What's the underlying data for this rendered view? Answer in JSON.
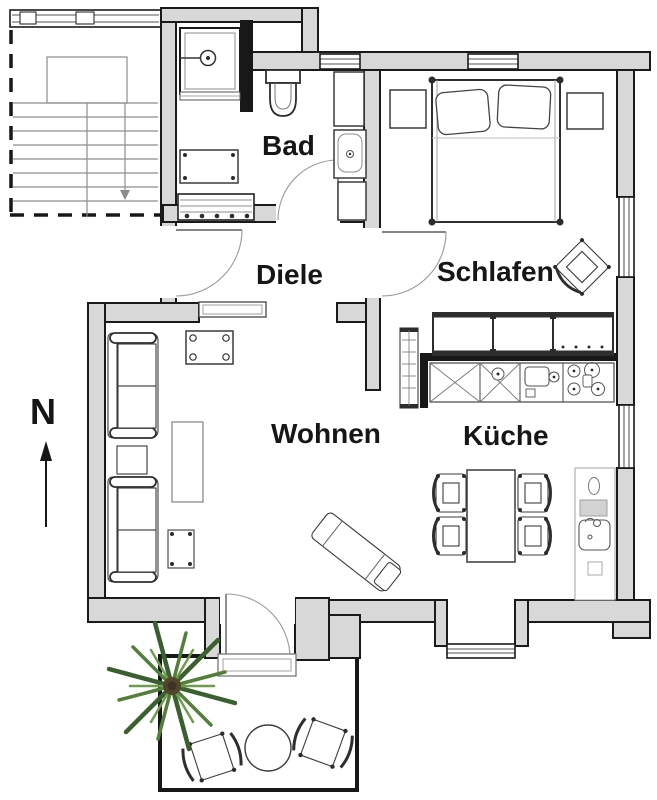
{
  "plan": {
    "type": "apartment-floor-plan",
    "units_shown": false
  },
  "rooms": [
    {
      "id": "bad",
      "label": "Bad"
    },
    {
      "id": "diele",
      "label": "Diele"
    },
    {
      "id": "schlafen",
      "label": "Schlafen"
    },
    {
      "id": "wohnen",
      "label": "Wohnen"
    },
    {
      "id": "kueche",
      "label": "Küche"
    }
  ],
  "compass": {
    "north_label": "N"
  },
  "colors": {
    "background": "#ffffff",
    "wall_fill": "#d8d8d8",
    "outline": "#1a1a1a",
    "furniture_line": "#3c3c3c",
    "light_line": "#8c8c8c",
    "plant_dark": "#39602e",
    "plant_mid": "#527f3a",
    "plant_light": "#6f9c4e",
    "plant_trunk": "#53452c"
  },
  "icons": [
    "staircase-icon",
    "shower-icon",
    "toilet-icon",
    "washbasin-icon",
    "bath-cabinet-icon",
    "washing-machine-icon",
    "hall-wardrobe-icon",
    "doormat-icon",
    "double-bed-icon",
    "pillow-icon",
    "nightstand-icon",
    "bedroom-chair-icon",
    "wardrobe-icon",
    "kitchen-counter-icon",
    "sink-icon",
    "stove-icon",
    "dining-table-icon",
    "dining-chair-icon",
    "kitchenette-icon",
    "sofa-icon",
    "side-table-icon",
    "coffee-table-icon",
    "stool-icon",
    "console-table-icon",
    "lounger-icon",
    "tv-bench-icon",
    "terrace-table-icon",
    "terrace-chair-icon",
    "potted-plant-icon",
    "north-arrow-icon",
    "door-swing-icon",
    "window-icon"
  ]
}
